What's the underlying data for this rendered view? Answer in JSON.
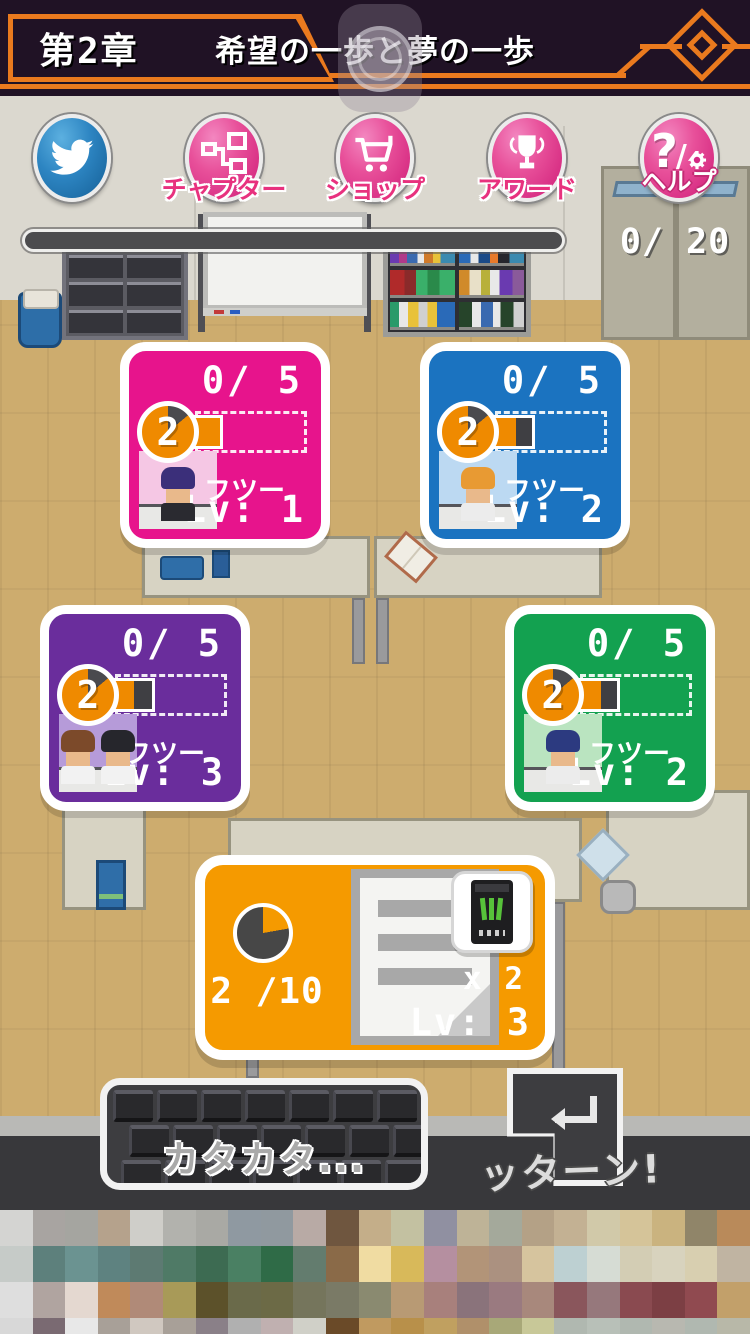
{
  "header": {
    "chapter": "第2章",
    "title": "希望の一歩と夢の一歩"
  },
  "toolbar": {
    "buttons": [
      {
        "name": "twitter",
        "label": ""
      },
      {
        "name": "chapter",
        "label": "チャプター"
      },
      {
        "name": "shop",
        "label": "ショップ"
      },
      {
        "name": "award",
        "label": "アワード"
      },
      {
        "name": "help",
        "label": "ヘルプ"
      }
    ]
  },
  "stage": {
    "locker_counter": "0/ 20"
  },
  "cards": [
    {
      "color": "#e7148c",
      "count": "0/ 5",
      "badge": "2",
      "fill_orange": 30,
      "fill_dark": 0,
      "avatar_bg": "#f5c7e4",
      "people": [
        {
          "hair": "#3b2f7a",
          "shirt": "#2a2a30"
        }
      ],
      "mood": "フツー",
      "level": "Lv: 1"
    },
    {
      "color": "#1b73c0",
      "count": "0/ 5",
      "badge": "2",
      "fill_orange": 26,
      "fill_dark": 16,
      "avatar_bg": "#bcd9f2",
      "people": [
        {
          "hair": "#e89a33",
          "shirt": "#ececec"
        }
      ],
      "mood": "フツー",
      "level": "Lv: 2"
    },
    {
      "color": "#6a2d9c",
      "count": "0/ 5",
      "badge": "2",
      "fill_orange": 24,
      "fill_dark": 18,
      "avatar_bg": "#b69bd9",
      "people": [
        {
          "hair": "#7c4a2a",
          "shirt": "#f2f2f2"
        },
        {
          "hair": "#26262c",
          "shirt": "#f2f2f2"
        }
      ],
      "mood": "フツー",
      "level": "Lv: 3"
    },
    {
      "color": "#13a150",
      "count": "0/ 5",
      "badge": "2",
      "fill_orange": 26,
      "fill_dark": 16,
      "avatar_bg": "#bae4c0",
      "people": [
        {
          "hair": "#2c3a80",
          "shirt": "#ececec"
        }
      ],
      "mood": "フツー",
      "level": "Lv: 2"
    }
  ],
  "writing_card": {
    "color": "#f59a00",
    "pie_progress": "2 /10",
    "item_count": "x 2",
    "level": "Lv: 3"
  },
  "sfx": {
    "typing": "カタカタ...",
    "enter": "ッターン!"
  },
  "ad_mosaic": {
    "row_heights": [
      36,
      36,
      36,
      16
    ],
    "rows": [
      [
        "#d4d4d2",
        "#a8a4a1",
        "#a5a5a0",
        "#b5a28c",
        "#cfcec9",
        "#b2b2ad",
        "#a9a9a4",
        "#8f99a1",
        "#90999f",
        "#b8aaa5",
        "#6f563f",
        "#c4ae89",
        "#c3c1a1",
        "#9090a1",
        "#beb397",
        "#a4a99b",
        "#b4a186",
        "#c3b193",
        "#d1c9a9",
        "#d5c499",
        "#cab37f",
        "#908569",
        "#b98a5a"
      ],
      [
        "#c6cbc8",
        "#5d807c",
        "#6b9391",
        "#5e8280",
        "#5d7a72",
        "#4f7a66",
        "#3d6b52",
        "#4a8063",
        "#2f6b47",
        "#637c6e",
        "#8a6a48",
        "#f0dca2",
        "#d8b95a",
        "#b58fa0",
        "#b29478",
        "#ab9180",
        "#d6c49e",
        "#bdd0d2",
        "#d6dcd4",
        "#d3cdb4",
        "#d8d3be",
        "#d8cfb0",
        "#c0b4a2"
      ],
      [
        "#dedede",
        "#b0a4a0",
        "#e4d8d0",
        "#c08a5a",
        "#b08a78",
        "#a89a58",
        "#5c512a",
        "#6a6a4a",
        "#6c6a46",
        "#75755c",
        "#7a7a66",
        "#8a8a70",
        "#b89a74",
        "#a8807c",
        "#8a737b",
        "#9a7a80",
        "#a8887c",
        "#8a565c",
        "#96787c",
        "#8a4a50",
        "#7c3f44",
        "#904a50",
        "#c2a06a"
      ],
      [
        "#d8d8d8",
        "#7a6a72",
        "#e8e8e8",
        "#a8a098",
        "#d0c8c0",
        "#a8a098",
        "#8a8088",
        "#b0b0b0",
        "#c0b0b0",
        "#d0d0c8",
        "#6a4a28",
        "#c09a60",
        "#b8904a",
        "#c0a060",
        "#b0906a",
        "#a8a878",
        "#c8c898",
        "#b0b8b0",
        "#b8c0b8",
        "#b0b8b0",
        "#b8b8b0",
        "#b0b8b0",
        "#b8b8a8"
      ]
    ]
  }
}
